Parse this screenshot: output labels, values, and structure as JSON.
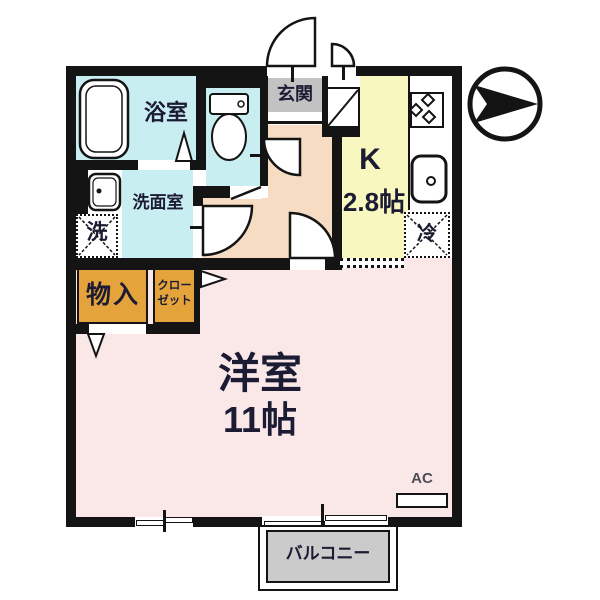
{
  "doc": {
    "type": "floor-plan",
    "background": "#ffffff"
  },
  "colors": {
    "wall": "#141414",
    "text": "#1b1b33",
    "wet_room_cyan": "#C9EEF2",
    "kitchen_yellow": "#F8F7C0",
    "hall_peach": "#F5DCC2",
    "main_room_pink": "#FAE8E8",
    "entrance_gray": "#C2C2C2",
    "balcony_gray": "#CBCBCB",
    "storage_orange": "#E5A33C",
    "ac_text_gray": "#4d4d55"
  },
  "rooms": {
    "bath": {
      "label": "浴室"
    },
    "washroom": {
      "label": "洗面室"
    },
    "entrance": {
      "label": "玄関"
    },
    "kitchen": {
      "label": "K",
      "size": "2.8帖"
    },
    "storage": {
      "label": "物入"
    },
    "closet": {
      "label_line1": "クロー",
      "label_line2": "ゼット"
    },
    "main_room": {
      "label": "洋室",
      "size": "11帖"
    },
    "balcony": {
      "label": "バルコニー"
    }
  },
  "fixtures": {
    "laundry_box": {
      "label": "洗"
    },
    "fridge_box": {
      "label": "冷"
    },
    "air_conditioner": {
      "label": "AC"
    },
    "icons": [
      "bathtub-icon",
      "toilet-icon",
      "washbasin-icon",
      "stove-icon",
      "kitchen-sink-icon",
      "shoe-cabinet-icon",
      "door-swing-arc",
      "folding-door-triangle",
      "sliding-window",
      "compass-north-arrow"
    ]
  },
  "compass": {
    "points": "right"
  }
}
